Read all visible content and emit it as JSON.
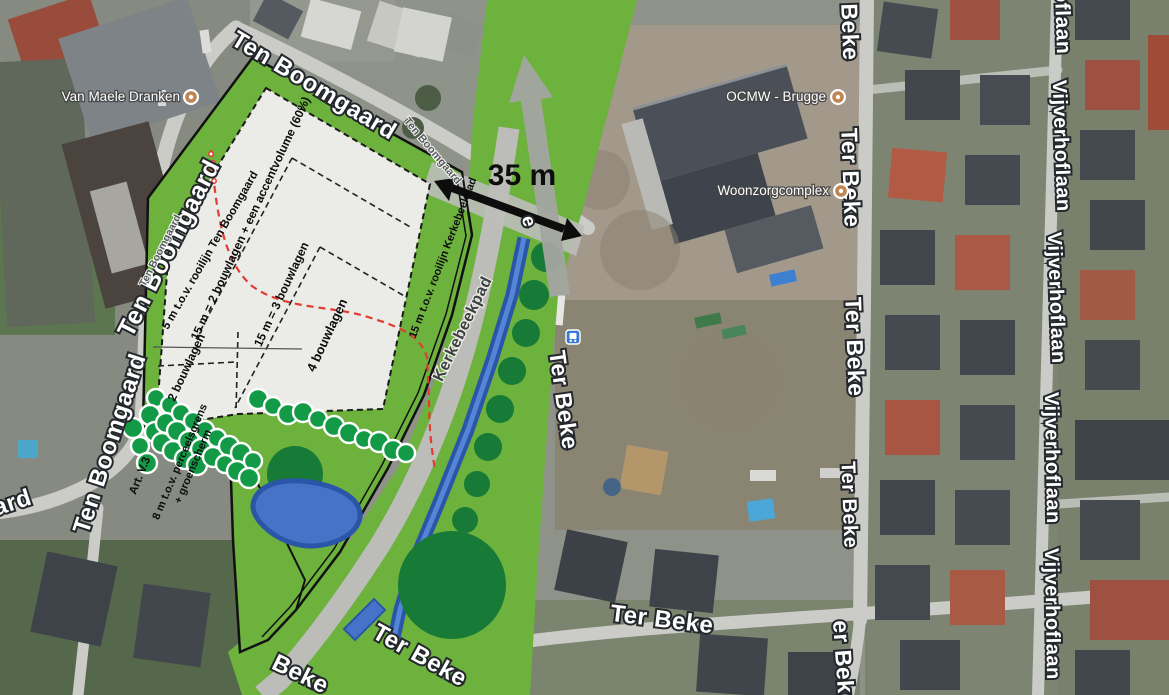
{
  "poi": {
    "van_maele": "Van Maele Dranken",
    "ocmw": "OCMW - Brugge",
    "woonzorgcomplex": "Woonzorgcomplex"
  },
  "streets": {
    "ten_boomgaard": "Ten Boomgaard",
    "ter_beke": "Ter Beke",
    "vijverhoflaan": "Vijverhoflaan",
    "kerkebeekpad": "Kerkebeekpad",
    "partial_aard": "aard",
    "partial_r_beke": "r Beke",
    "partial_er_beke": "er Beke",
    "partial_beke": "Beke",
    "partial_oflaan": "oflaan",
    "partial_e": "e"
  },
  "plan": {
    "setback_ten_boomgaard": "5 m t.o.v. rooilijn Ten Boomgaard",
    "zone_2_accent": "15 m = 2 bouwlagen + een accentvolume (60%)",
    "zone_3": "15 m = 3 bouwlagen",
    "zone_4": "4 bouwlagen",
    "zone_2": "2 bouwlagen",
    "setback_kerkebeekpad": "15 m t.o.v. rooilijn Kerkebeekpad",
    "setback_perceelsgrens_line1": "8 m t.o.v. perceelsgrens",
    "setback_perceelsgrens_line2": "+ groenscherm",
    "article": "Art. V.3",
    "distance": "35 m"
  },
  "colors": {
    "overlay_green": "#6cb23d",
    "tree_dark": "#177a36",
    "tree_bright": "#129a47",
    "water_fill": "#4673c8",
    "water_dark": "#2b56a8",
    "path_gray": "#bcbdb9",
    "road_gray": "#cbccc8",
    "arrow_gray": "#a3a5a0",
    "accent_red": "#e23b32",
    "label_outline": "#24282c",
    "annotation_black": "#0d0d0d",
    "poi_icon_tan": "#c08552",
    "busstop_blue": "#3a78d6"
  }
}
